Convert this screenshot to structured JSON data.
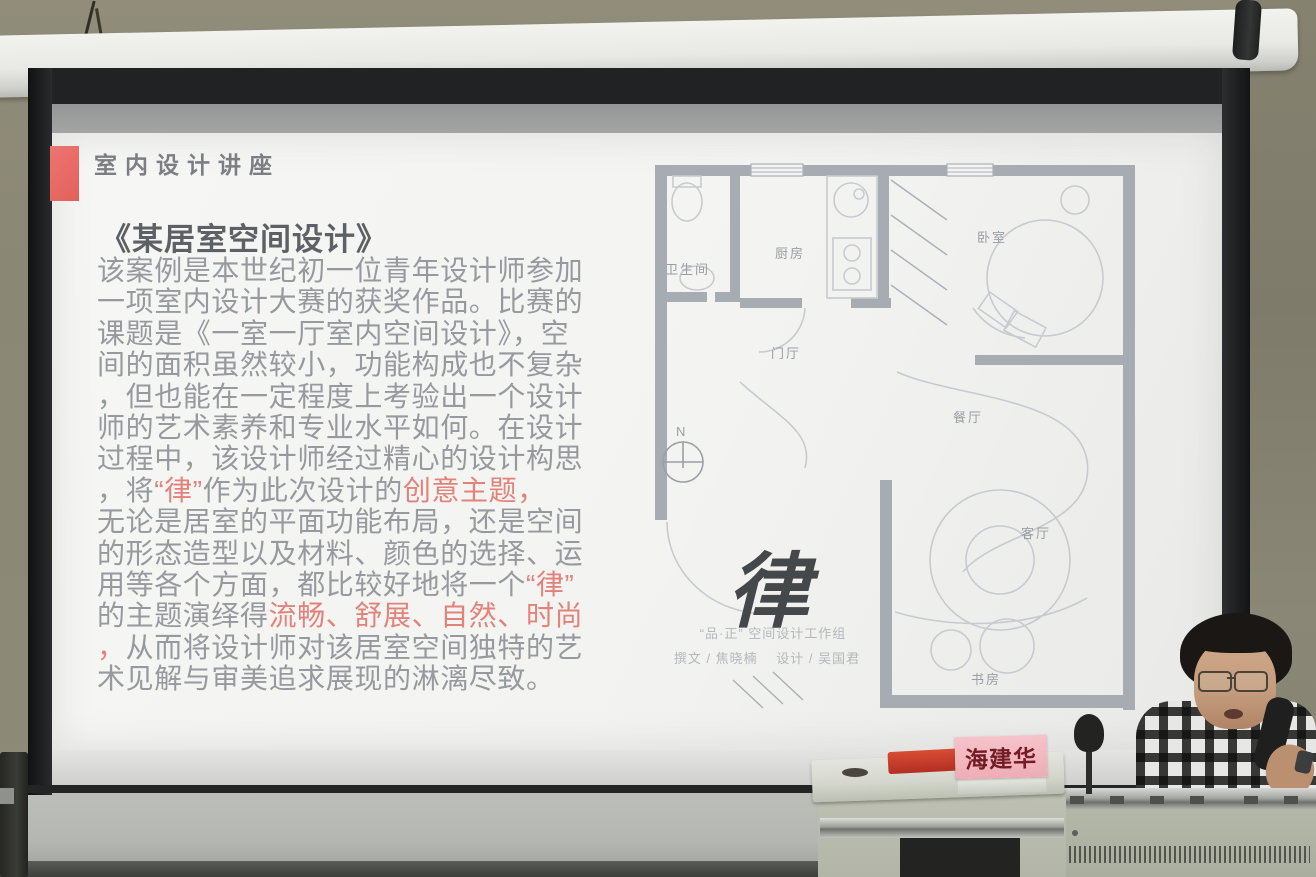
{
  "slide": {
    "header": "室内设计讲座",
    "title": "《某居室空间设计》",
    "accent_red": "#e2837b",
    "bullet_color": "#e8655f",
    "paragraph_lines": [
      {
        "segments": [
          {
            "text": "该案例是本世纪初一位青年设计师参加",
            "red": false
          }
        ]
      },
      {
        "segments": [
          {
            "text": "一项室内设计大赛的获奖作品。比赛的",
            "red": false
          }
        ]
      },
      {
        "segments": [
          {
            "text": "课题是《一室一厅室内空间设计》，空",
            "red": false
          }
        ]
      },
      {
        "segments": [
          {
            "text": "间的面积虽然较小，功能构成也不复杂",
            "red": false
          }
        ]
      },
      {
        "segments": [
          {
            "text": "，但也能在一定程度上考验出一个设计",
            "red": false
          }
        ]
      },
      {
        "segments": [
          {
            "text": "师的艺术素养和专业水平如何。在设计",
            "red": false
          }
        ]
      },
      {
        "segments": [
          {
            "text": "过程中，该设计师经过精心的设计构思",
            "red": false
          }
        ]
      },
      {
        "segments": [
          {
            "text": "，将",
            "red": false
          },
          {
            "text": "“律”",
            "red": true
          },
          {
            "text": "作为此次设计的",
            "red": false
          },
          {
            "text": "创意主题，",
            "red": true
          }
        ]
      },
      {
        "segments": [
          {
            "text": "无论是居室的平面功能布局，还是空间",
            "red": false
          }
        ]
      },
      {
        "segments": [
          {
            "text": "的形态造型以及材料、颜色的选择、运",
            "red": false
          }
        ]
      },
      {
        "segments": [
          {
            "text": "用等各个方面，都比较好地将一个",
            "red": false
          },
          {
            "text": "“律”",
            "red": true
          }
        ]
      },
      {
        "segments": [
          {
            "text": "的主题演绎得",
            "red": false
          },
          {
            "text": "流畅、舒展、自然、时尚",
            "red": true
          }
        ]
      },
      {
        "segments": [
          {
            "text": "，",
            "red": true
          },
          {
            "text": "从而将设计师对该居室空间独特的艺",
            "red": false
          }
        ]
      },
      {
        "segments": [
          {
            "text": "术见解与审美追求展现的淋漓尽致。",
            "red": false
          }
        ]
      }
    ],
    "floor_plan": {
      "rooms": {
        "bathroom": "卫生间",
        "kitchen": "厨房",
        "bedroom": "卧室",
        "foyer": "门厅",
        "dining": "餐厅",
        "living": "客厅",
        "study": "书房"
      },
      "north_label": "N",
      "calligraphy": "律",
      "studio_line": "“品·正” 空间设计工作组",
      "credit_line": "撰文 / 焦晓楠　 设计 / 吴国君"
    }
  },
  "scene": {
    "name_card": "海建华"
  }
}
